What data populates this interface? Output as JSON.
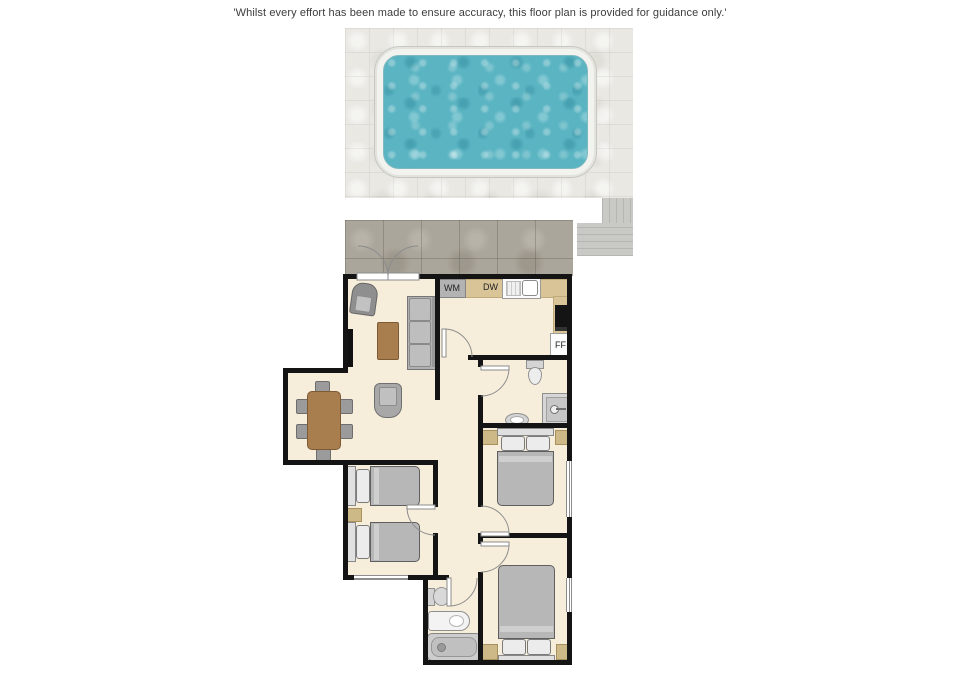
{
  "disclaimer": "'Whilst every effort has been made to ensure accuracy, this floor plan is provided for guidance only.'",
  "kitchen": {
    "wm_label": "WM",
    "dw_label": "DW",
    "ff_label": "FF"
  },
  "colors": {
    "pool_water": "#5ab4c2",
    "pool_rim": "#f2f2ef",
    "pool_deck_tile": "#e9e8e3",
    "terrace_tile": "#aba69b",
    "steps": "#c9c9c6",
    "floor": "#f6eeda",
    "wall": "#141414",
    "kitchen_counter": "#d9c498",
    "wood_furniture": "#a97e4f",
    "gray_furniture": "#b5b5b5"
  }
}
